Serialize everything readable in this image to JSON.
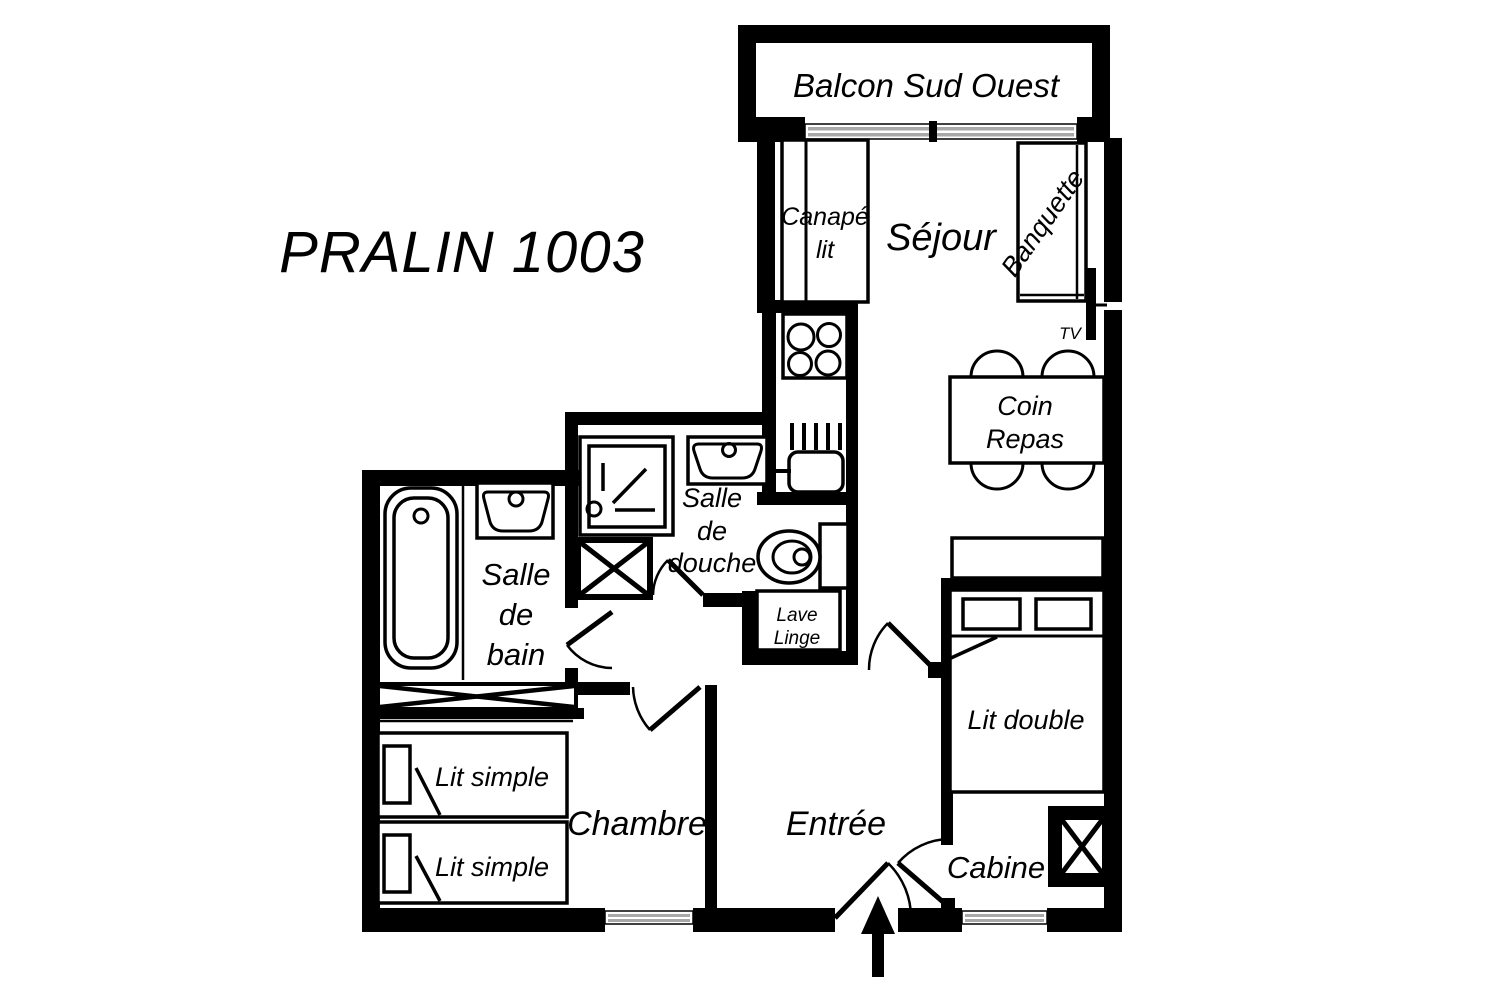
{
  "title": "PRALIN 1003",
  "colors": {
    "wall": "#000000",
    "background": "#ffffff",
    "window_glass": "#a8a8a8"
  },
  "rooms": {
    "balcony": "Balcon Sud Ouest",
    "living_room": "Séjour",
    "dining": {
      "line1": "Coin",
      "line2": "Repas"
    },
    "shower_room": {
      "line1": "Salle",
      "line2": "de",
      "line3": "douche"
    },
    "bathroom": {
      "line1": "Salle",
      "line2": "de",
      "line3": "bain"
    },
    "bedroom": "Chambre",
    "entrance": "Entrée",
    "cabin": "Cabine"
  },
  "furniture": {
    "sofa_bed": {
      "line1": "Canapé",
      "line2": "lit"
    },
    "bench": "Banquette",
    "tv": "TV",
    "washing_machine": {
      "line1": "Lave",
      "line2": "Linge"
    },
    "single_bed_1": "Lit simple",
    "single_bed_2": "Lit simple",
    "double_bed": "Lit double"
  }
}
